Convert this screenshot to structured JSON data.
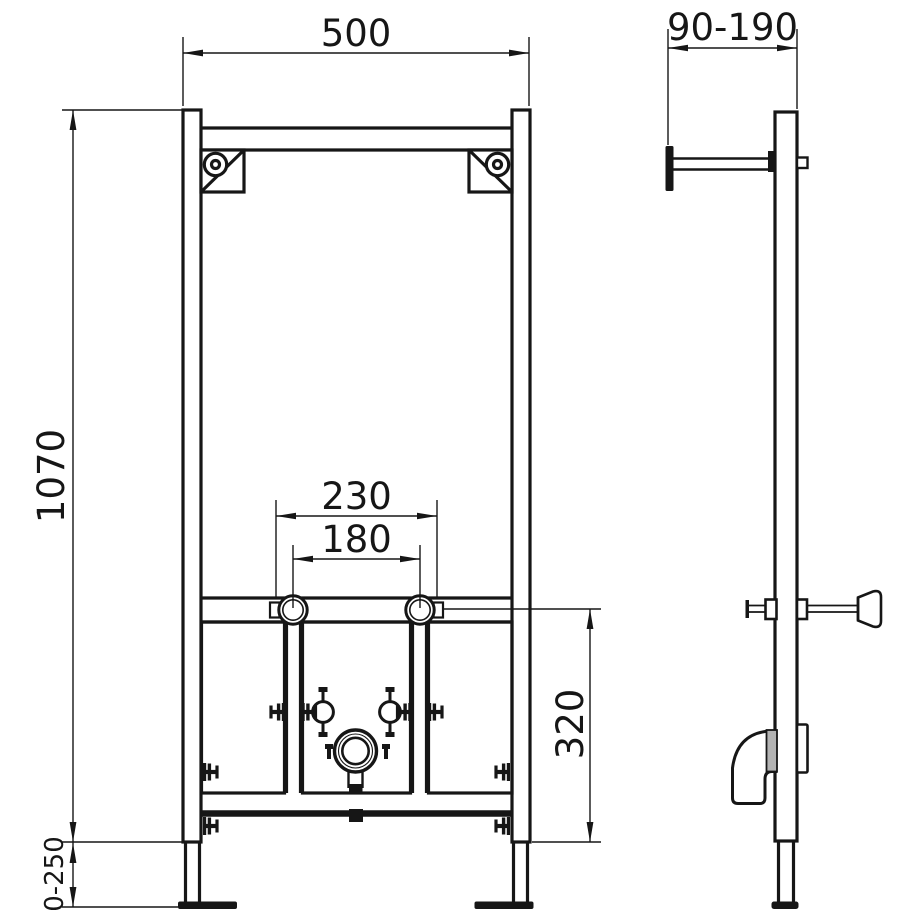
{
  "drawing": {
    "description": "Technical installation drawing of a wall-mounted WC/bidet mounting frame, front view and side view",
    "background_color": "#ffffff",
    "line_color": "#161616",
    "pipe_socket_color": "#b3b3b3",
    "dimensions": {
      "frame_width": "500",
      "wall_bracket_depth_range": "90-190",
      "frame_height": "1070",
      "fixing_spacing_outer": "230",
      "fixing_spacing_inner": "180",
      "outlet_section_height": "320",
      "leg_extension_range": "0-250"
    }
  }
}
